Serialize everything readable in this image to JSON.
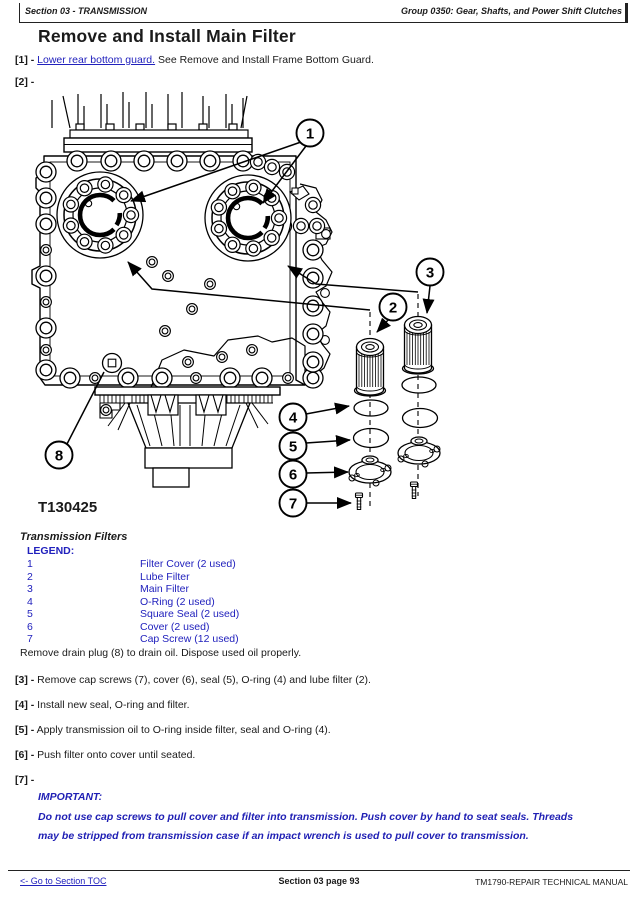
{
  "colors": {
    "link_blue": "#2121bd",
    "important_blue": "#1f1fb4",
    "text": "#1a1a1a"
  },
  "header": {
    "section": "Section 03 - TRANSMISSION",
    "group": "Group 0350: Gear, Shafts, and Power Shift Clutches"
  },
  "page": {
    "title": "Remove and Install Main Filter"
  },
  "steps": {
    "s1": {
      "label": "[1] -",
      "link": "Lower rear bottom guard.",
      "text": "See Remove and Install Frame Bottom Guard."
    },
    "s2": {
      "label": "[2] -"
    },
    "s3": {
      "label": "[3] -",
      "text": "Remove cap screws (7), cover (6), seal (5), O-ring (4) and lube filter (2)."
    },
    "s4": {
      "label": "[4] -",
      "text": "Install new seal, O-ring and filter."
    },
    "s5": {
      "label": "[5] -",
      "text": "Apply transmission oil to O-ring inside filter, seal and O-ring (4)."
    },
    "s6": {
      "label": "[6] -",
      "text": "Push filter onto cover until seated."
    },
    "s7": {
      "label": "[7] -"
    }
  },
  "figure": {
    "caption": "T130425",
    "title": "Transmission Filters",
    "callouts": [
      "1",
      "2",
      "3",
      "4",
      "5",
      "6",
      "7",
      "8"
    ]
  },
  "legend": {
    "heading": "LEGEND:",
    "items": [
      {
        "num": "1",
        "label": "Filter Cover (2 used)"
      },
      {
        "num": "2",
        "label": "Lube Filter"
      },
      {
        "num": "3",
        "label": "Main Filter"
      },
      {
        "num": "4",
        "label": "O-Ring (2 used)"
      },
      {
        "num": "5",
        "label": "Square Seal (2 used)"
      },
      {
        "num": "6",
        "label": "Cover (2 used)"
      },
      {
        "num": "7",
        "label": "Cap Screw (12 used)"
      }
    ],
    "note": "Remove drain plug (8) to drain oil. Dispose used oil properly."
  },
  "important": {
    "heading": "IMPORTANT:",
    "text": "Do not use cap screws to pull cover and filter into transmission. Push cover by hand to seat seals. Threads may be stripped from transmission case if an impact wrench is used to pull cover to transmission."
  },
  "footer": {
    "toc_link": "<- Go to Section TOC",
    "page": "Section 03 page 93",
    "manual": "TM1790-REPAIR TECHNICAL MANUAL"
  }
}
